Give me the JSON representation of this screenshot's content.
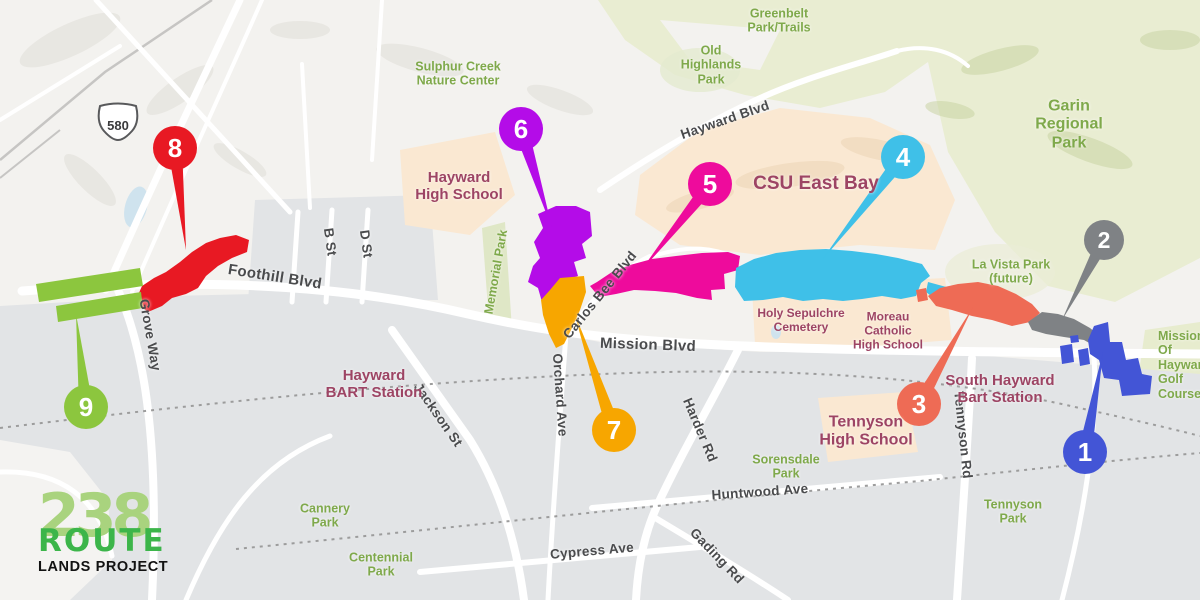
{
  "title": "Route 238 Lands Project map",
  "logo": {
    "number": "238",
    "route": "ROUTE",
    "subtitle": "LANDS PROJECT"
  },
  "highway_shield": {
    "label": "580"
  },
  "streets": {
    "foothill": "Foothill Blvd",
    "mission": "Mission Blvd",
    "grove": "Grove Way",
    "b_st": "B St",
    "d_st": "D St",
    "jackson": "Jackson St",
    "orchard": "Orchard Ave",
    "carlos_bee": "Carlos Bee Blvd",
    "harder": "Harder Rd",
    "hayward_blvd": "Hayward Blvd",
    "tennyson_rd": "Tennyson Rd",
    "huntwood": "Huntwood Ave",
    "cypress": "Cypress Ave",
    "gading": "Gading Rd"
  },
  "parks": {
    "sulphur_creek": "Sulphur Creek\nNature Center",
    "greenbelt": "Greenbelt\nPark/Trails",
    "old_highlands": "Old\nHighlands\nPark",
    "garin": "Garin\nRegional\nPark",
    "la_vista": "La Vista Park\n(future)",
    "memorial": "Memorial Park",
    "sorensdale": "Sorensdale\nPark",
    "cannery": "Cannery\nPark",
    "centennial": "Centennial\nPark",
    "tennyson_park": "Tennyson\nPark",
    "mission_golf": "Mission\nOf Hayward\nGolf Course"
  },
  "schools": {
    "hayward_high": "Hayward\nHigh School",
    "csu": "CSU East Bay",
    "holy_sepulchre": "Holy Sepulchre\nCemetery",
    "moreau": "Moreau\nCatholic\nHigh School",
    "tennyson_high": "Tennyson\nHigh School"
  },
  "stations": {
    "hayward_bart": "Hayward\nBART Station",
    "south_hayward_bart": "South Hayward\nBart Station"
  },
  "markers": {
    "m1": {
      "number": "1",
      "color": "#4355d6"
    },
    "m2": {
      "number": "2",
      "color": "#7f8285"
    },
    "m3": {
      "number": "3",
      "color": "#ee6b55"
    },
    "m4": {
      "number": "4",
      "color": "#3fc0e8"
    },
    "m5": {
      "number": "5",
      "color": "#ee0b9c"
    },
    "m6": {
      "number": "6",
      "color": "#b40ce8"
    },
    "m7": {
      "number": "7",
      "color": "#f7a600"
    },
    "m8": {
      "number": "8",
      "color": "#e81923"
    },
    "m9": {
      "number": "9",
      "color": "#8cc63e"
    }
  },
  "colors": {
    "park_label": "#7fa94b",
    "school_label": "#9d4464",
    "street_label": "#4a4b4d",
    "park_fill": "#e9edd2",
    "school_fill": "#fae8d2",
    "urban_fill": "#e2e4e6",
    "terrain_fill": "#f3f2ef",
    "water_fill": "#cfe3ee",
    "logo_number": "#a9d37e",
    "logo_route": "#3cb54a",
    "logo_subtitle": "#121212"
  }
}
